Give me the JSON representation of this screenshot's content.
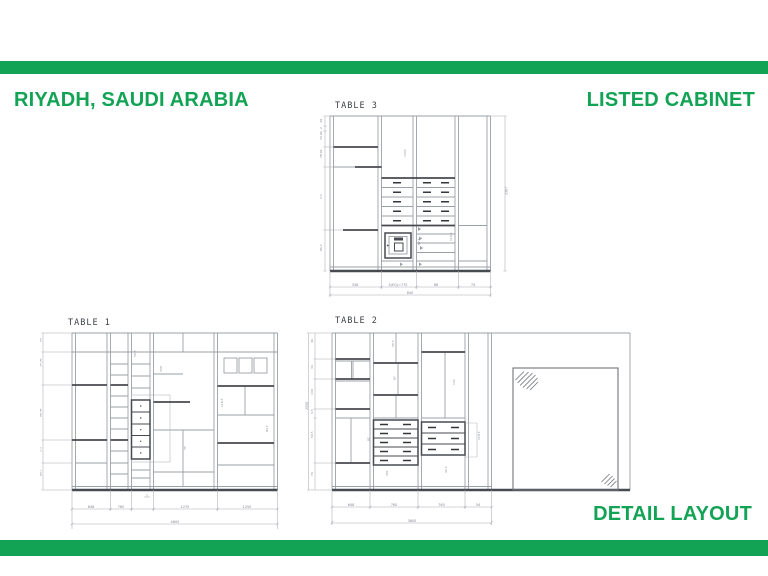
{
  "header": {
    "location": "RIYADH, SAUDI ARABIA",
    "title": "LISTED CABINET"
  },
  "footer": {
    "label": "DETAIL LAYOUT"
  },
  "theme": {
    "green": "#12a355",
    "line_gray": "#9ba0a7",
    "line_dark": "#474a50",
    "dim_text": "#83878e"
  },
  "tables": {
    "t3": {
      "label": "TABLE 3",
      "dims_left": [
        "40",
        "2",
        "34.06",
        "78.94",
        "3.3",
        "86.7"
      ],
      "dim_right": "2387",
      "dims_bottom": [
        "338",
        "4(EQ)=775",
        "88",
        "74"
      ],
      "dim_total": "840",
      "dims_inner": [
        "1333",
        "87.5",
        "118.5"
      ]
    },
    "t1": {
      "label": "TABLE 1",
      "dims_left": [
        "40",
        "34.06",
        "98.94",
        "3.3",
        "86.7"
      ],
      "dims_bottom": [
        "648",
        "760",
        "1270",
        "1250"
      ],
      "dim_total": "4600",
      "dims_inner": [
        "330",
        "75",
        "50.5",
        "84.7",
        "118.5"
      ]
    },
    "t2": {
      "label": "TABLE 2",
      "dim_height": "2550",
      "dims_left": [
        "46",
        "34",
        "130",
        "4.5",
        "50.5",
        "74"
      ],
      "dims_bottom": [
        "648",
        "760",
        "760",
        "54"
      ],
      "dim_total": "3600",
      "dims_inner": [
        "50.5",
        "87",
        "135",
        "118.5",
        "43.5",
        "761",
        "87"
      ]
    }
  }
}
